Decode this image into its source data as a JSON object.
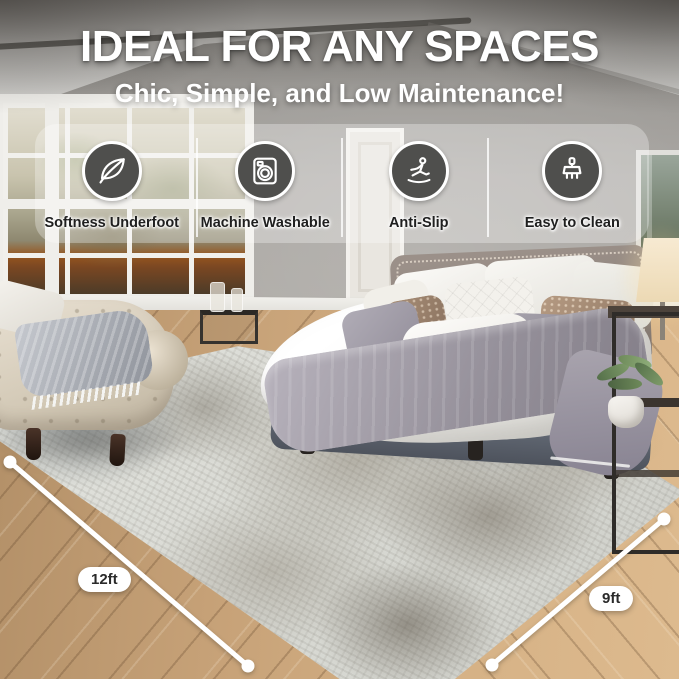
{
  "header": {
    "title": "IDEAL FOR ANY SPACES",
    "subtitle": "Chic, Simple, and Low Maintenance!"
  },
  "features": [
    {
      "label": "Softness Underfoot",
      "icon": "feather-icon"
    },
    {
      "label": "Machine Washable",
      "icon": "washing-machine-icon"
    },
    {
      "label": "Anti-Slip",
      "icon": "slipping-person-icon"
    },
    {
      "label": "Easy to Clean",
      "icon": "cleaning-brush-icon"
    }
  ],
  "dimensions": {
    "length_label": "12ft",
    "width_label": "9ft"
  },
  "colors": {
    "headline_text": "#ffffff",
    "icon_badge_fill": "#4f4f4d",
    "icon_badge_ring": "#ffffff",
    "feature_label_text": "#1f1f1f",
    "panel_overlay": "rgba(255,255,255,0.30)",
    "dimension_line": "#ffffff",
    "dimension_pill_bg": "#ffffff",
    "dimension_pill_text": "#2a2a2a"
  }
}
